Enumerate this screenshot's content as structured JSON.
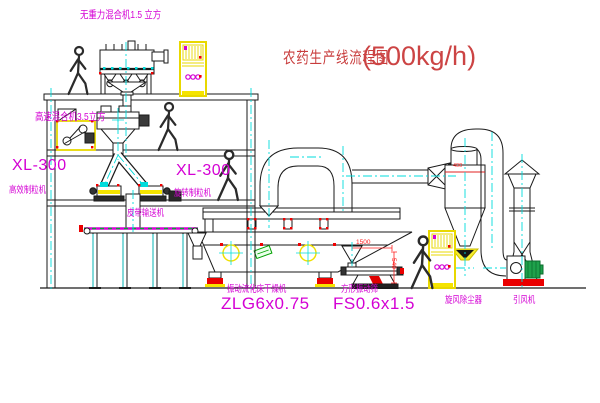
{
  "title": {
    "text": "农药生产线流程图",
    "capacity": "(500kg/h)"
  },
  "equipment_labels": {
    "gravity_mixer": "无重力混合机1.5 立方",
    "high_speed_mixer": "高速混合机3.5立方",
    "granulator_left": {
      "model": "XL-300",
      "name": "高效制粒机"
    },
    "granulator_mid": {
      "model": "XL-300",
      "name": "旋转制粒机"
    },
    "belt_conveyor": "皮带输送机",
    "fluid_bed_dryer": {
      "name": "振动流化床干燥机",
      "model": "ZLG6x0.75"
    },
    "vibrating_screen": {
      "name": "方形振动筛",
      "model": "FS0.6x1.5"
    },
    "cyclone": "旋风除尘器",
    "induced_draft_fan": "引风机"
  },
  "dimensions": {
    "screen_length": "1500",
    "screen_height": "540",
    "cyclone_mark": "400"
  },
  "colors": {
    "label_magenta": "#d400d4",
    "title_red": "#c83c3c",
    "dimension_red": "#ff2020",
    "equipment_yellow": "#f0e000",
    "centerline_cyan": "#00dcdc",
    "fan_green": "#1ea24b"
  },
  "icons": {
    "worker_icon": "walking-person-silhouette",
    "worker_count": 4
  }
}
